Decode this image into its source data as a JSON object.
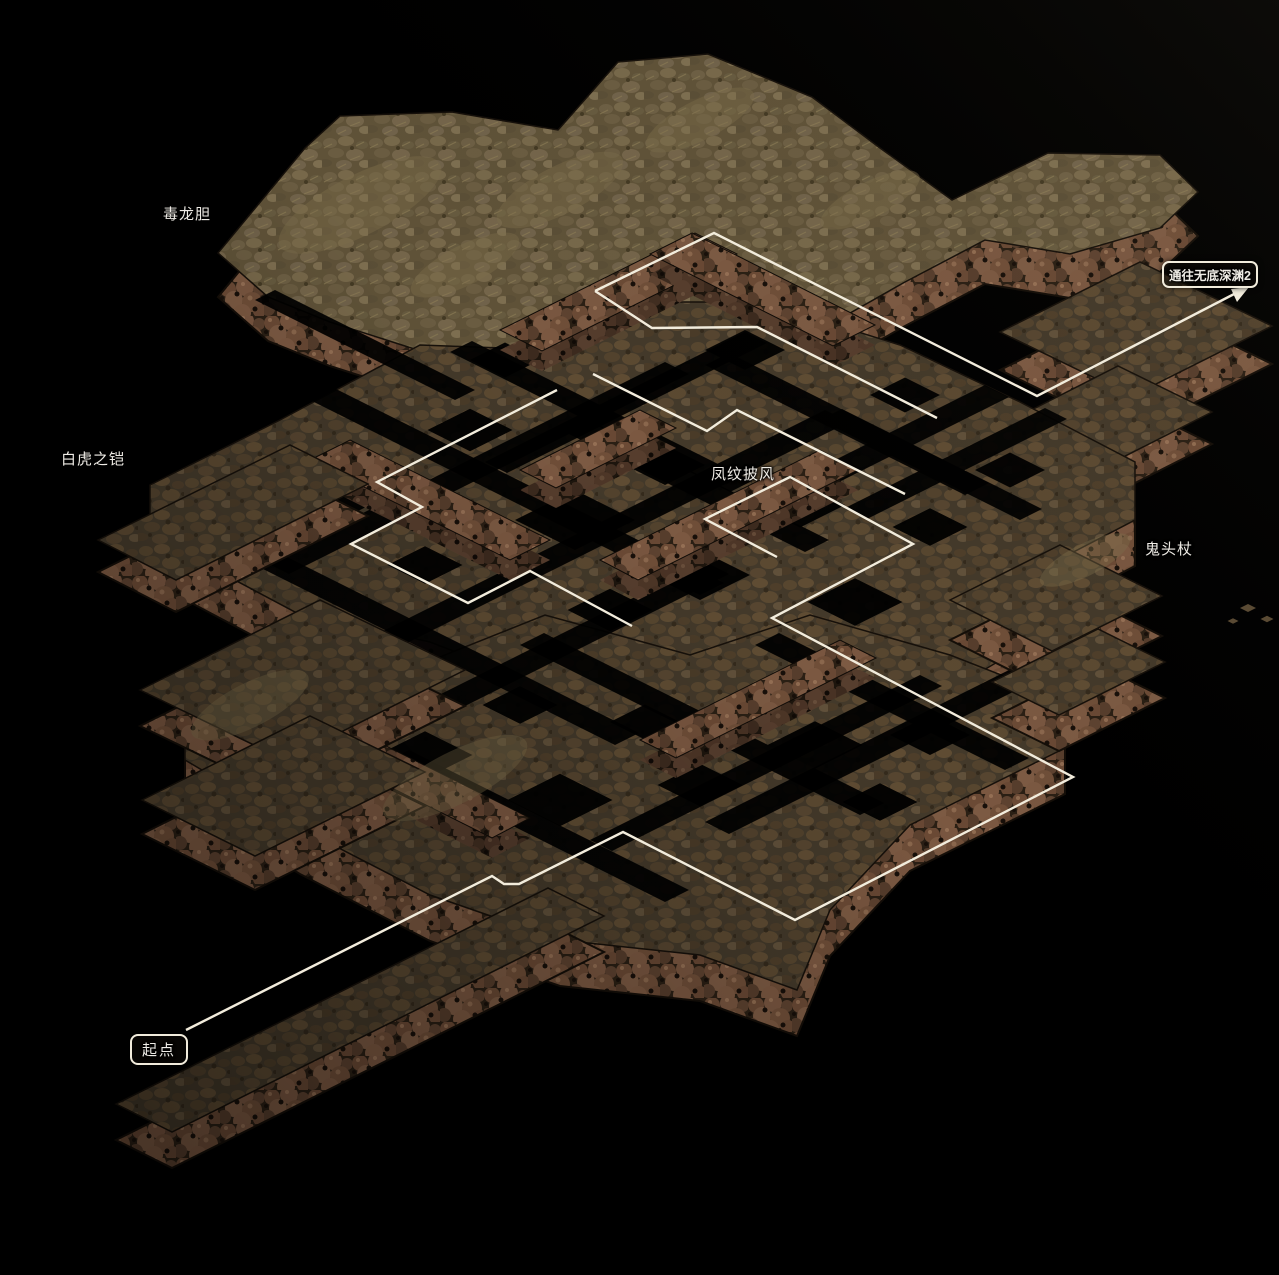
{
  "canvas": {
    "width": 1279,
    "height": 1275
  },
  "colors": {
    "background": "#000000",
    "route_line": "#f2ecdc",
    "label_text": "#efece6",
    "box_border": "#f2ecdc",
    "surface_dark": "#43392a",
    "surface_light": "#5f5238",
    "wall_base": "#2a1f14",
    "boulders": [
      "#6b4a35",
      "#795640",
      "#5d4230",
      "#836049",
      "#6f4e38"
    ],
    "moss": "#7d6f4c"
  },
  "labels": [
    {
      "id": "item-dulongdan",
      "text": "毒龙胆",
      "x": 163,
      "y": 203,
      "boxed": false,
      "small": false
    },
    {
      "id": "item-baihuzhikai",
      "text": "白虎之铠",
      "x": 61,
      "y": 448,
      "boxed": false,
      "small": false
    },
    {
      "id": "item-fengwenpifeng",
      "text": "凤纹披风",
      "x": 711,
      "y": 463,
      "boxed": false,
      "small": false
    },
    {
      "id": "item-guitouzhang",
      "text": "鬼头杖",
      "x": 1145,
      "y": 538,
      "boxed": false,
      "small": false
    },
    {
      "id": "start-point",
      "text": "起点",
      "x": 130,
      "y": 1034,
      "boxed": true,
      "small": false
    },
    {
      "id": "exit-abyss",
      "text": "通往无底深渊2",
      "x": 1162,
      "y": 261,
      "boxed": true,
      "small": true
    }
  ],
  "route": {
    "color": "#f2ecdc",
    "width": 2.4,
    "polylines": [
      {
        "name": "route-main",
        "pts": [
          [
            186,
            1030
          ],
          [
            492,
            876
          ],
          [
            504,
            884
          ],
          [
            519,
            884
          ],
          [
            623,
            832
          ],
          [
            795,
            920
          ],
          [
            1073,
            777
          ],
          [
            772,
            618
          ],
          [
            913,
            544
          ],
          [
            790,
            477
          ],
          [
            705,
            519
          ],
          [
            777,
            557
          ]
        ]
      },
      {
        "name": "route-loop-left",
        "pts": [
          [
            557,
            390
          ],
          [
            377,
            482
          ],
          [
            422,
            507
          ],
          [
            351,
            544
          ],
          [
            468,
            603
          ],
          [
            530,
            571
          ],
          [
            632,
            626
          ]
        ]
      },
      {
        "name": "route-upper-a",
        "pts": [
          [
            593,
            374
          ],
          [
            707,
            431
          ],
          [
            737,
            410
          ],
          [
            905,
            494
          ]
        ]
      },
      {
        "name": "route-upper-b",
        "pts": [
          [
            595,
            291
          ],
          [
            652,
            328
          ],
          [
            757,
            327
          ],
          [
            937,
            418
          ]
        ]
      },
      {
        "name": "route-exit",
        "pts": [
          [
            595,
            291
          ],
          [
            714,
            233
          ],
          [
            1037,
            396
          ],
          [
            1238,
            292
          ]
        ]
      }
    ],
    "arrow_head": [
      [
        1249,
        287
      ],
      [
        1237,
        302
      ],
      [
        1231,
        289
      ]
    ]
  },
  "terrain": {
    "platforms": [
      {
        "name": "top-mass",
        "surface": "light",
        "wall": 44,
        "phase": 1,
        "pts": [
          [
            218,
            253
          ],
          [
            305,
            148
          ],
          [
            340,
            116
          ],
          [
            452,
            112
          ],
          [
            558,
            130
          ],
          [
            618,
            62
          ],
          [
            708,
            54
          ],
          [
            812,
            97
          ],
          [
            880,
            148
          ],
          [
            952,
            200
          ],
          [
            1048,
            153
          ],
          [
            1160,
            155
          ],
          [
            1198,
            192
          ],
          [
            1160,
            228
          ],
          [
            1070,
            254
          ],
          [
            985,
            240
          ],
          [
            905,
            282
          ],
          [
            820,
            330
          ],
          [
            760,
            302
          ],
          [
            692,
            332
          ],
          [
            600,
            322
          ],
          [
            520,
            347
          ],
          [
            430,
            354
          ],
          [
            330,
            322
          ],
          [
            268,
            297
          ]
        ]
      },
      {
        "name": "abyss-arm",
        "surface": "dark",
        "wall": 38,
        "phase": 1,
        "pts": [
          [
            1000,
            332
          ],
          [
            1140,
            262
          ],
          [
            1272,
            326
          ],
          [
            1132,
            396
          ]
        ]
      },
      {
        "name": "right-ledge",
        "surface": "dark",
        "wall": 32,
        "phase": 1,
        "pts": [
          [
            988,
            432
          ],
          [
            1118,
            366
          ],
          [
            1212,
            412
          ],
          [
            1082,
            478
          ]
        ]
      },
      {
        "name": "central-band",
        "surface": "dark",
        "wall": 46,
        "phase": 1,
        "pts": [
          [
            150,
            485
          ],
          [
            280,
            420
          ],
          [
            420,
            345
          ],
          [
            555,
            350
          ],
          [
            622,
            302
          ],
          [
            762,
            302
          ],
          [
            900,
            345
          ],
          [
            1020,
            402
          ],
          [
            1135,
            462
          ],
          [
            1135,
            520
          ],
          [
            1010,
            585
          ],
          [
            1055,
            628
          ],
          [
            950,
            690
          ],
          [
            825,
            660
          ],
          [
            700,
            702
          ],
          [
            560,
            692
          ],
          [
            430,
            642
          ],
          [
            295,
            612
          ],
          [
            150,
            535
          ]
        ]
      },
      {
        "name": "lower-band",
        "surface": "dark",
        "wall": 46,
        "phase": 1,
        "pts": [
          [
            185,
            700
          ],
          [
            300,
            645
          ],
          [
            420,
            665
          ],
          [
            545,
            615
          ],
          [
            690,
            655
          ],
          [
            810,
            615
          ],
          [
            950,
            655
          ],
          [
            1065,
            700
          ],
          [
            1065,
            748
          ],
          [
            910,
            825
          ],
          [
            830,
            910
          ],
          [
            797,
            990
          ],
          [
            700,
            955
          ],
          [
            560,
            940
          ],
          [
            430,
            895
          ],
          [
            300,
            828
          ],
          [
            185,
            760
          ]
        ]
      },
      {
        "name": "east-arm-upper",
        "surface": "dark",
        "wall": 40,
        "phase": 2,
        "pts": [
          [
            950,
            600
          ],
          [
            1060,
            545
          ],
          [
            1162,
            596
          ],
          [
            1052,
            651
          ]
        ]
      },
      {
        "name": "east-arm-lower",
        "surface": "dark",
        "wall": 36,
        "phase": 2,
        "pts": [
          [
            992,
            682
          ],
          [
            1098,
            629
          ],
          [
            1165,
            662
          ],
          [
            1059,
            715
          ]
        ]
      },
      {
        "name": "west-arm",
        "surface": "dark",
        "wall": 32,
        "phase": 2,
        "pts": [
          [
            98,
            540
          ],
          [
            290,
            445
          ],
          [
            368,
            484
          ],
          [
            176,
            580
          ]
        ]
      },
      {
        "name": "west-blob-upper",
        "surface": "dark",
        "wall": 36,
        "phase": 2,
        "pts": [
          [
            140,
            690
          ],
          [
            320,
            600
          ],
          [
            465,
            670
          ],
          [
            285,
            760
          ]
        ]
      },
      {
        "name": "west-blob-lower",
        "surface": "dark",
        "wall": 34,
        "phase": 2,
        "pts": [
          [
            142,
            800
          ],
          [
            310,
            716
          ],
          [
            425,
            772
          ],
          [
            255,
            856
          ]
        ]
      },
      {
        "name": "start-corridor",
        "surface": "dark",
        "wall": 36,
        "phase": 2,
        "pts": [
          [
            116,
            1104
          ],
          [
            548,
            888
          ],
          [
            604,
            916
          ],
          [
            172,
            1132
          ]
        ]
      }
    ],
    "ridges": [
      [
        [
          500,
          330
        ],
        [
          695,
          233
        ],
        [
          737,
          254
        ],
        [
          542,
          351
        ]
      ],
      [
        [
          692,
          233
        ],
        [
          875,
          325
        ],
        [
          833,
          346
        ],
        [
          650,
          254
        ]
      ],
      [
        [
          350,
          440
        ],
        [
          550,
          540
        ],
        [
          510,
          560
        ],
        [
          310,
          460
        ]
      ],
      [
        [
          600,
          560
        ],
        [
          820,
          450
        ],
        [
          858,
          470
        ],
        [
          638,
          580
        ]
      ],
      [
        [
          330,
          718
        ],
        [
          530,
          818
        ],
        [
          492,
          838
        ],
        [
          292,
          738
        ]
      ],
      [
        [
          640,
          740
        ],
        [
          840,
          640
        ],
        [
          876,
          658
        ],
        [
          676,
          758
        ]
      ],
      [
        [
          520,
          470
        ],
        [
          640,
          410
        ],
        [
          676,
          428
        ],
        [
          556,
          488
        ]
      ]
    ],
    "channels": [
      {
        "x": 300,
        "y": 395,
        "len": 400,
        "dir": "a",
        "w": 24
      },
      {
        "x": 450,
        "y": 352,
        "len": 280,
        "dir": "a",
        "w": 22
      },
      {
        "x": 565,
        "y": 432,
        "len": 240,
        "dir": "a",
        "w": 24
      },
      {
        "x": 255,
        "y": 565,
        "len": 360,
        "dir": "a",
        "w": 24
      },
      {
        "x": 520,
        "y": 645,
        "len": 340,
        "dir": "a",
        "w": 24
      },
      {
        "x": 705,
        "y": 365,
        "len": 260,
        "dir": "a",
        "w": 24
      },
      {
        "x": 385,
        "y": 762,
        "len": 280,
        "dir": "a",
        "w": 24
      },
      {
        "x": 755,
        "y": 645,
        "len": 250,
        "dir": "a",
        "w": 24
      },
      {
        "x": 820,
        "y": 420,
        "len": 200,
        "dir": "a",
        "w": 22
      },
      {
        "x": 255,
        "y": 300,
        "len": 200,
        "dir": "a",
        "w": 20
      },
      {
        "x": 265,
        "y": 562,
        "len": 400,
        "dir": "b",
        "w": 24
      },
      {
        "x": 355,
        "y": 645,
        "len": 470,
        "dir": "b",
        "w": 24
      },
      {
        "x": 305,
        "y": 762,
        "len": 400,
        "dir": "b",
        "w": 24
      },
      {
        "x": 590,
        "y": 840,
        "len": 330,
        "dir": "b",
        "w": 22
      },
      {
        "x": 625,
        "y": 565,
        "len": 360,
        "dir": "b",
        "w": 24
      },
      {
        "x": 485,
        "y": 462,
        "len": 260,
        "dir": "b",
        "w": 22
      },
      {
        "x": 705,
        "y": 822,
        "len": 330,
        "dir": "b",
        "w": 24
      },
      {
        "x": 845,
        "y": 508,
        "len": 200,
        "dir": "b",
        "w": 22
      }
    ],
    "holes": [
      [
        355,
        485,
        110
      ],
      [
        470,
        430,
        85
      ],
      [
        575,
        520,
        120
      ],
      [
        665,
        465,
        80
      ],
      [
        700,
        575,
        100
      ],
      [
        800,
        505,
        90
      ],
      [
        855,
        602,
        95
      ],
      [
        930,
        527,
        75
      ],
      [
        610,
        610,
        85
      ],
      [
        425,
        565,
        75
      ],
      [
        505,
        360,
        70
      ],
      [
        745,
        350,
        80
      ],
      [
        905,
        395,
        70
      ],
      [
        425,
        755,
        95
      ],
      [
        560,
        800,
        105
      ],
      [
        700,
        785,
        85
      ],
      [
        815,
        745,
        95
      ],
      [
        880,
        802,
        75
      ],
      [
        520,
        705,
        75
      ],
      [
        645,
        722,
        70
      ],
      [
        350,
        705,
        65
      ],
      [
        930,
        735,
        80
      ],
      [
        300,
        775,
        60
      ],
      [
        1010,
        470,
        70
      ]
    ],
    "moss": [
      [
        360,
        205,
        90,
        30
      ],
      [
        560,
        190,
        70,
        24
      ],
      [
        465,
        265,
        60,
        20
      ],
      [
        700,
        120,
        60,
        20
      ],
      [
        250,
        705,
        65,
        22
      ],
      [
        455,
        778,
        80,
        26
      ],
      [
        1085,
        560,
        50,
        16
      ],
      [
        870,
        200,
        55,
        18
      ]
    ],
    "deco_tiles": [
      [
        1248,
        608,
        16
      ],
      [
        1267,
        619,
        13
      ],
      [
        1233,
        621,
        11
      ]
    ]
  }
}
